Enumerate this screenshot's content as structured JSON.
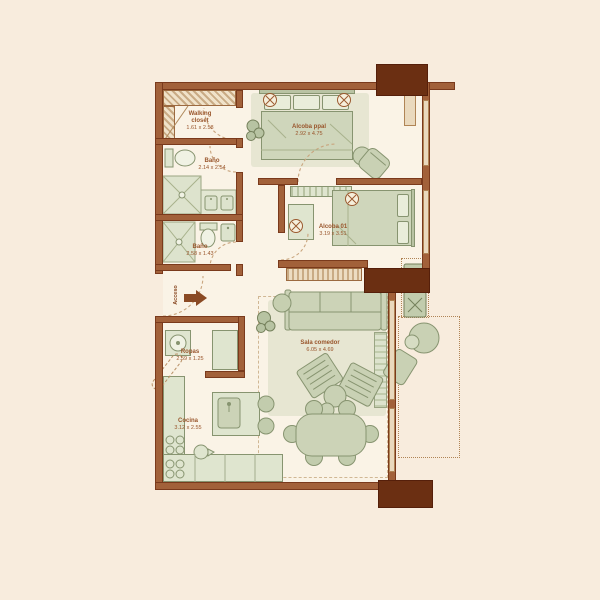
{
  "plan": {
    "type": "apartment-floor-plan",
    "entrance": {
      "label": "Acceso"
    },
    "rooms": [
      {
        "id": "walking-closet",
        "name": "Walking\ncloset",
        "dimensions": "1.61 x 2.58"
      },
      {
        "id": "bano-1",
        "name": "Baño",
        "dimensions": "2.14 x 2.54"
      },
      {
        "id": "bano-2",
        "name": "Baño",
        "dimensions": "2.58 x 1.43"
      },
      {
        "id": "alcoba-ppal",
        "name": "Alcoba ppal",
        "dimensions": "2.92 x 4.75"
      },
      {
        "id": "alcoba-01",
        "name": "Alcoba 01",
        "dimensions": "3.19 x 3.51"
      },
      {
        "id": "ropas",
        "name": "Ropas",
        "dimensions": "2.59 x 1.25"
      },
      {
        "id": "cocina",
        "name": "Cocina",
        "dimensions": "3.12 x 2.55"
      },
      {
        "id": "sala-comedor",
        "name": "Sala comedor",
        "dimensions": "6.05 x 4.69"
      }
    ],
    "colors": {
      "background": "#f8ecdd",
      "floor": "#faf3e6",
      "wall": "#a2613a",
      "wall_outline": "#7a3a1c",
      "column": "#6b2f12",
      "furniture": "#ccd3b7",
      "furniture_light": "#dfe5cf",
      "furniture_outline": "#879470",
      "label_text": "#99552b",
      "dashed_lines": "#c9a57e"
    }
  }
}
